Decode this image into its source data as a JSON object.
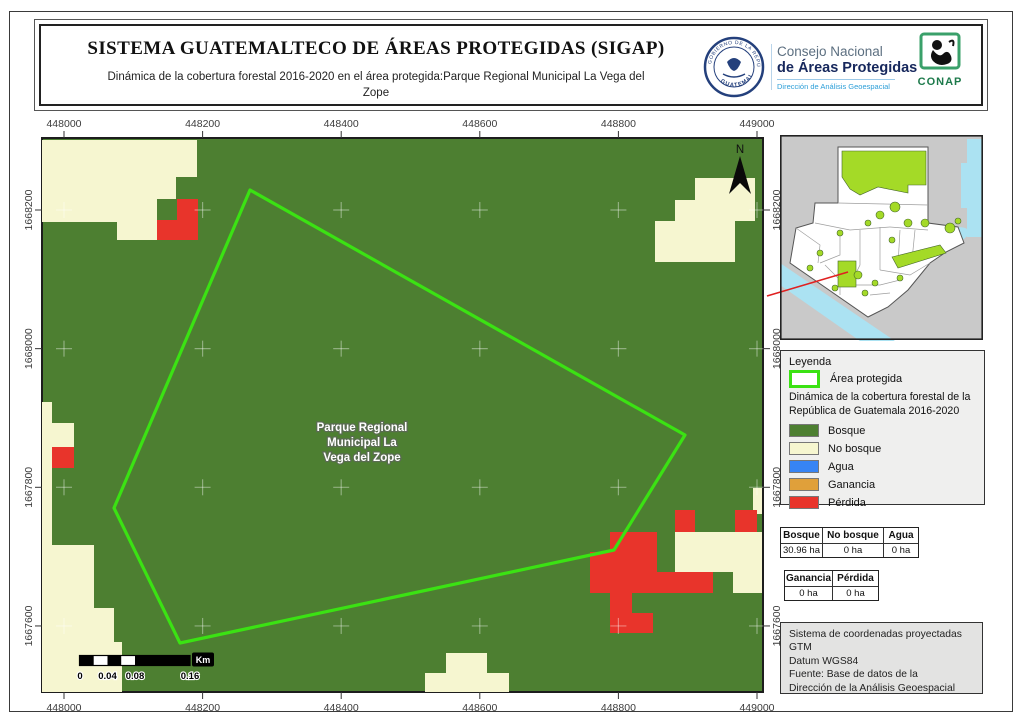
{
  "header": {
    "title": "SISTEMA GUATEMALTECO DE ÁREAS PROTEGIDAS (SIGAP)",
    "subtitle": "Dinámica de la cobertura forestal 2016-2020 en el área protegida:Parque Regional Municipal La Vega del Zope",
    "logos": {
      "gov_seal_top": "GOBIERNO DE LA REPÚBLICA",
      "gov_seal_bottom": "GUATEMALA",
      "org1": "Consejo Nacional",
      "org2": "de Áreas Protegidas",
      "org3": "Dirección de Análisis Geoespacial",
      "conap": "CONAP"
    }
  },
  "map": {
    "label_lines": [
      "Parque Regional",
      "Municipal La",
      "Vega del Zope"
    ],
    "north": "N",
    "x_axis": {
      "values": [
        "448000",
        "448200",
        "448400",
        "448600",
        "448800",
        "449000"
      ]
    },
    "y_axis": {
      "values": [
        "1668200",
        "1668000",
        "1667800",
        "1667600"
      ]
    },
    "scale": {
      "labels": [
        "0",
        "0.04",
        "0.08",
        "0.16"
      ],
      "unit": "Km"
    }
  },
  "legend": {
    "title": "Leyenda",
    "area_label": "Área protegida",
    "subtitle_line1": "Dinámica de la cobertura forestal de la",
    "subtitle_line2": "República de Guatemala 2016-2020",
    "items": [
      {
        "label": "Bosque",
        "color": "#4d7f31"
      },
      {
        "label": "No bosque",
        "color": "#f6f6d0"
      },
      {
        "label": "Agua",
        "color": "#3784f4"
      },
      {
        "label": "Ganancia",
        "color": "#e0a03a"
      },
      {
        "label": "Pérdida",
        "color": "#e8342b"
      }
    ]
  },
  "tables": {
    "t1": {
      "headers": [
        "Bosque",
        "No bosque",
        "Agua"
      ],
      "values": [
        "30.96 ha",
        "0 ha",
        "0 ha"
      ]
    },
    "t2": {
      "headers": [
        "Ganancia",
        "Pérdida"
      ],
      "values": [
        "0 ha",
        "0 ha"
      ]
    }
  },
  "info_box": {
    "lines": [
      "Sistema de coordenadas proyectadas",
      "GTM",
      "Datum WGS84",
      "Fuente: Base de datos de la",
      "Dirección de la Análisis Geoespacial"
    ]
  },
  "colors": {
    "bosque": "#4d7f31",
    "no_bosque": "#f6f6d0",
    "agua": "#3784f4",
    "ganancia": "#e0a03a",
    "perdida": "#e8342b",
    "area_line": "#3be213",
    "inset_green": "#a4da27",
    "inset_water": "#abe2f2",
    "inset_gray": "#c9c9c9"
  }
}
